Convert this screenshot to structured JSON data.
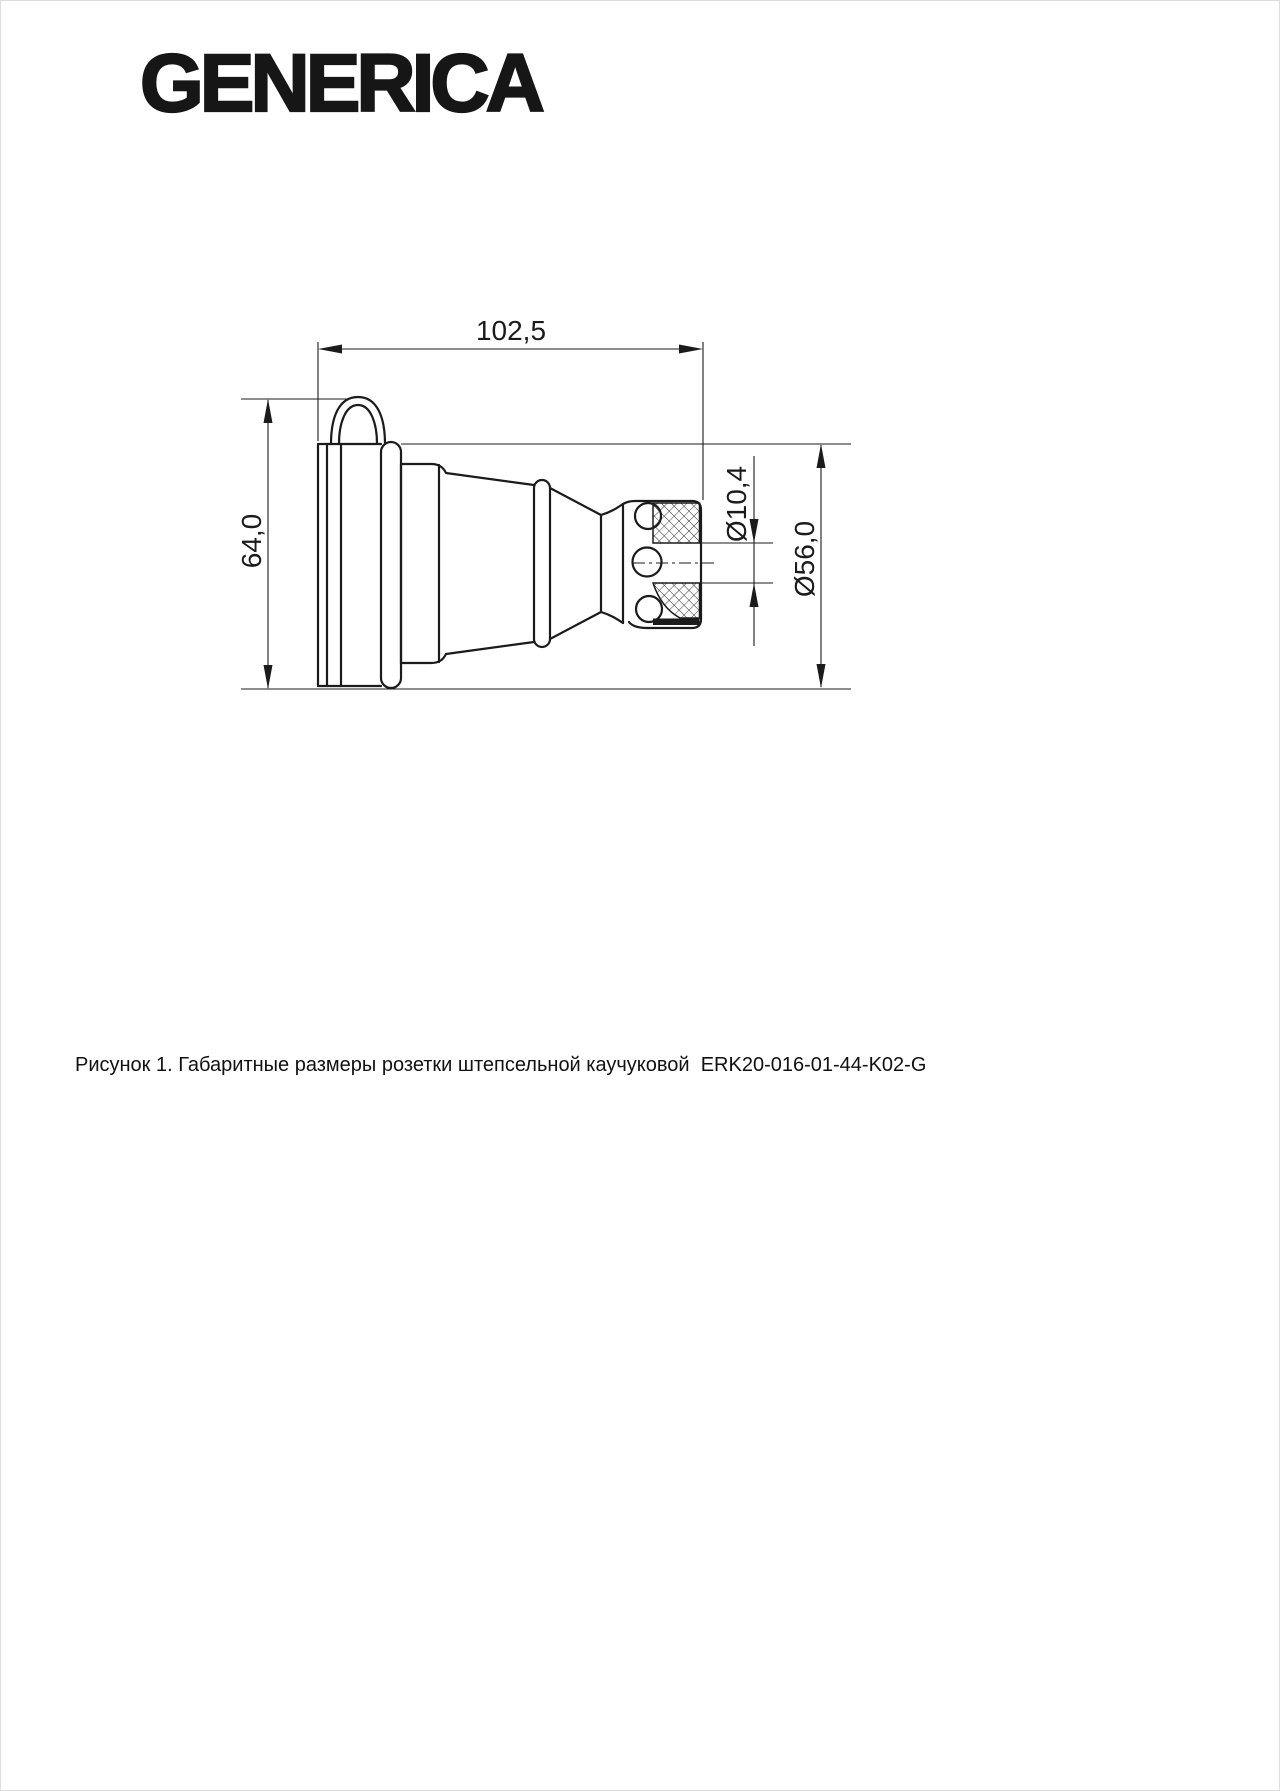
{
  "page": {
    "background": "#ffffff",
    "border_color": "#dcdcdc"
  },
  "header": {
    "logo_text": "GENERICA",
    "logo_color": "#161616"
  },
  "figure": {
    "type": "engineering-drawing",
    "line_color": "#1b1b1b",
    "dimensions": {
      "overall_length": "102,5",
      "overall_height": "64,0",
      "cable_hole_diameter": "Ø10,4",
      "body_diameter": "Ø56,0"
    }
  },
  "caption": {
    "text": "Рисунок 1. Габаритные размеры розетки штепсельной каучуковой  ERK20-016-01-44-K02-G"
  }
}
